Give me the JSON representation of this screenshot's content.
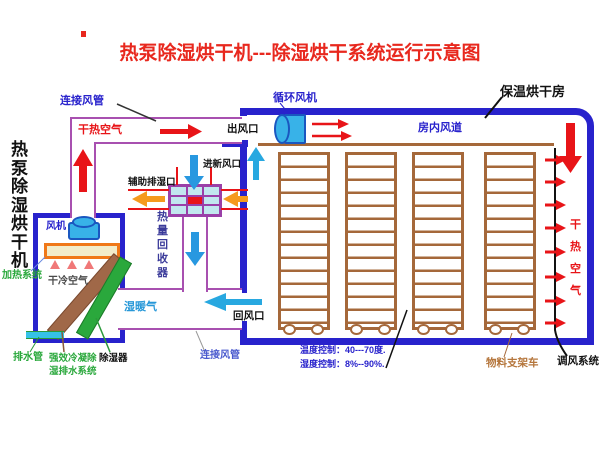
{
  "title": "热泵除湿烘干机---除湿烘干系统运行示意图",
  "machine": {
    "side_label": "热泵除湿烘干机",
    "fan": "风机",
    "heating_system": "加热系统",
    "dry_cold_air": "干冷空气",
    "drain_pipe": "排水管",
    "condensate_line1": "强效冷凝除",
    "condensate_line2": "湿排水系统",
    "dehumidifier": "除湿器"
  },
  "ducts": {
    "connect_top": "连接风管",
    "dry_hot_air": "干热空气",
    "outlet": "出风口",
    "wet_warm_air": "湿暖气",
    "return_inlet": "回风口",
    "connect_bottom": "连接风管"
  },
  "heat_recovery": {
    "fresh_air_inlet": "进新风口",
    "aux_exhaust_port": "辅助排湿口",
    "unit_label": "热量回收器"
  },
  "room": {
    "name": "保温烘干房",
    "circulation_fan": "循环风机",
    "inner_duct": "房内风道",
    "dry_hot_air": "干热空气",
    "material_rack": "物料支架车",
    "air_adjust_system": "调风系统",
    "temperature_control": "温度控制：40---70度.",
    "humidity_control": "湿度控制：8%--90%."
  },
  "colors": {
    "wall_blue": "#2822cc",
    "duct_purple": "#a850b0",
    "arrow_red": "#e81418",
    "arrow_orange": "#f59a1e",
    "arrow_cyan": "#28a8e0",
    "green_text": "#2aa83c",
    "rack_brown": "#a5683a",
    "title_red": "#e8281e"
  }
}
